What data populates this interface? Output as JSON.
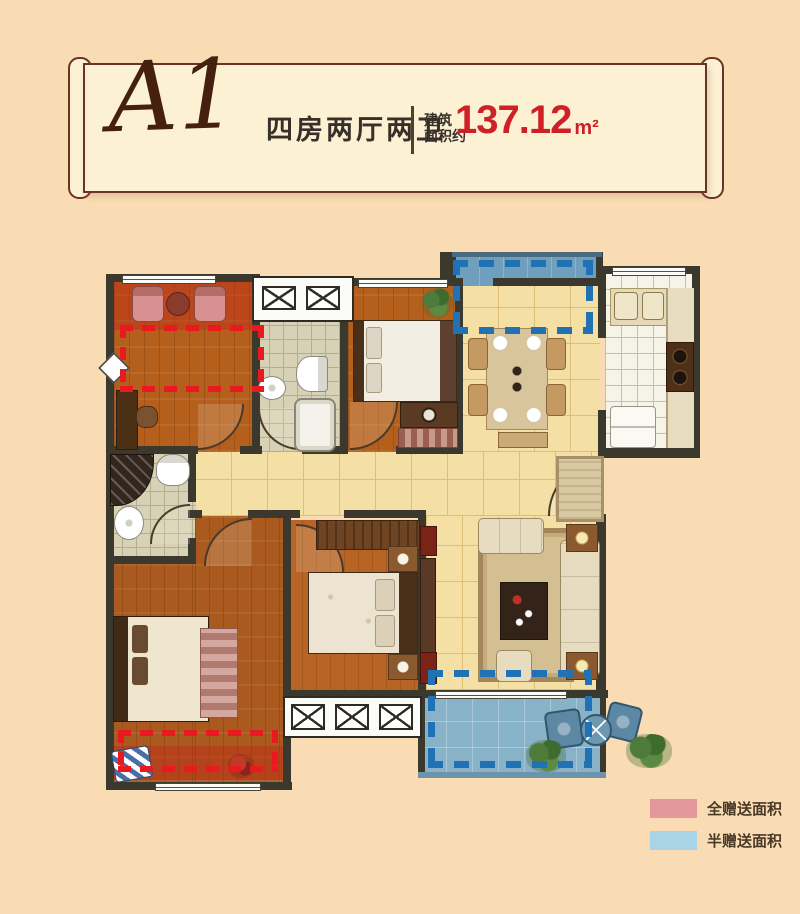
{
  "page": {
    "background": "#fadcb4"
  },
  "header": {
    "plan_code": "A1",
    "layout_label": "四房两厅两卫",
    "area_label_line1": "建筑",
    "area_label_line2": "面积约",
    "area_value": "137.12",
    "area_unit": "m²",
    "value_color": "#ce2027"
  },
  "legend": {
    "items": [
      {
        "label": "全赠送面积",
        "color": "#e5989b"
      },
      {
        "label": "半赠送面积",
        "color": "#a9d3e6"
      }
    ]
  },
  "plan": {
    "annotation_colors": {
      "full_gift_dash": "#e8191f",
      "half_gift_dash": "#2171b5"
    }
  }
}
